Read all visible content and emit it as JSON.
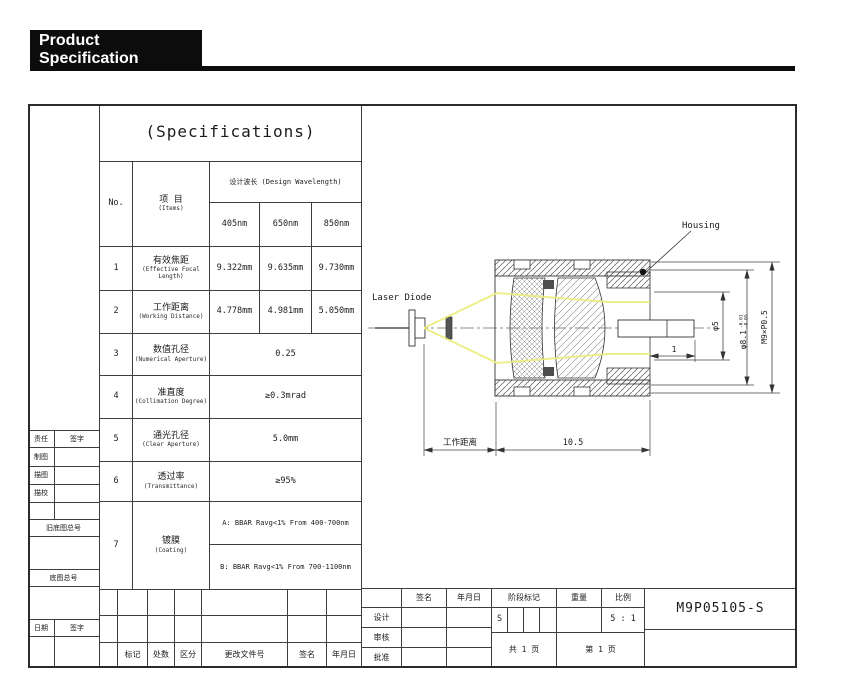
{
  "header": {
    "title": "Product Specification"
  },
  "spec_table": {
    "title": "(Specifications)",
    "col_no": "No.",
    "items_cn": "项 目",
    "items_en": "(Items)",
    "wavelength_header": "设计波长 (Design Wavelength)",
    "wavelengths": [
      "405nm",
      "650nm",
      "850nm"
    ],
    "rows": [
      {
        "no": "1",
        "cn": "有效焦距",
        "en": "(Effective Focal Length)",
        "values": [
          "9.322mm",
          "9.635mm",
          "9.730mm"
        ]
      },
      {
        "no": "2",
        "cn": "工作距离",
        "en": "(Working Distance)",
        "values": [
          "4.778mm",
          "4.981mm",
          "5.050mm"
        ]
      },
      {
        "no": "3",
        "cn": "数值孔径",
        "en": "(Numerical Aperture)",
        "value": "0.25"
      },
      {
        "no": "4",
        "cn": "准直度",
        "en": "(Collimation Degree)",
        "value": "≥0.3mrad"
      },
      {
        "no": "5",
        "cn": "通光孔径",
        "en": "(Clear Aperture)",
        "value": "5.0mm"
      },
      {
        "no": "6",
        "cn": "透过率",
        "en": "(Transmittance)",
        "value": "≥95%"
      },
      {
        "no": "7",
        "cn": "镀膜",
        "en": "(Coating)",
        "value_a": "A: BBAR Ravg<1% From 400-700nm",
        "value_b": "B: BBAR Ravg<1% From 700-1100nm"
      }
    ]
  },
  "drawing": {
    "laser_diode_label": "Laser Diode",
    "housing_label": "Housing",
    "dim_working_distance": "工作距离",
    "dim_total": "10.5",
    "dim_step": "1",
    "dim_phi5": "φ5",
    "dim_phi81": "φ8.1",
    "dim_phi81_tol_upper": "-0.01",
    "dim_phi81_tol_lower": "-0.05",
    "dim_thread": "M9×P0.5",
    "ray_color": "#ecec7c"
  },
  "left_panel": {
    "responsibility": "责任",
    "signature": "签字",
    "drafting": "制图",
    "tracing": "描图",
    "trace_check": "描校",
    "old_base_drawing_no": "旧底图总号",
    "base_drawing_no": "底图总号",
    "date": "日期",
    "signature2": "签字"
  },
  "revision_strip": {
    "labels": [
      "标记",
      "处数",
      "区分",
      "更改文件号",
      "签名",
      "年月日"
    ]
  },
  "title_block": {
    "sign": "签名",
    "date": "年月日",
    "stage_mark": "阶段标记",
    "weight": "重量",
    "scale_label": "比例",
    "design": "设计",
    "review": "审核",
    "approve": "批准",
    "stage_value": "S",
    "scale_value": "5 : 1",
    "pages_total": "共 1 页",
    "page_no": "第 1 页",
    "part_number": "M9P05105-S"
  }
}
